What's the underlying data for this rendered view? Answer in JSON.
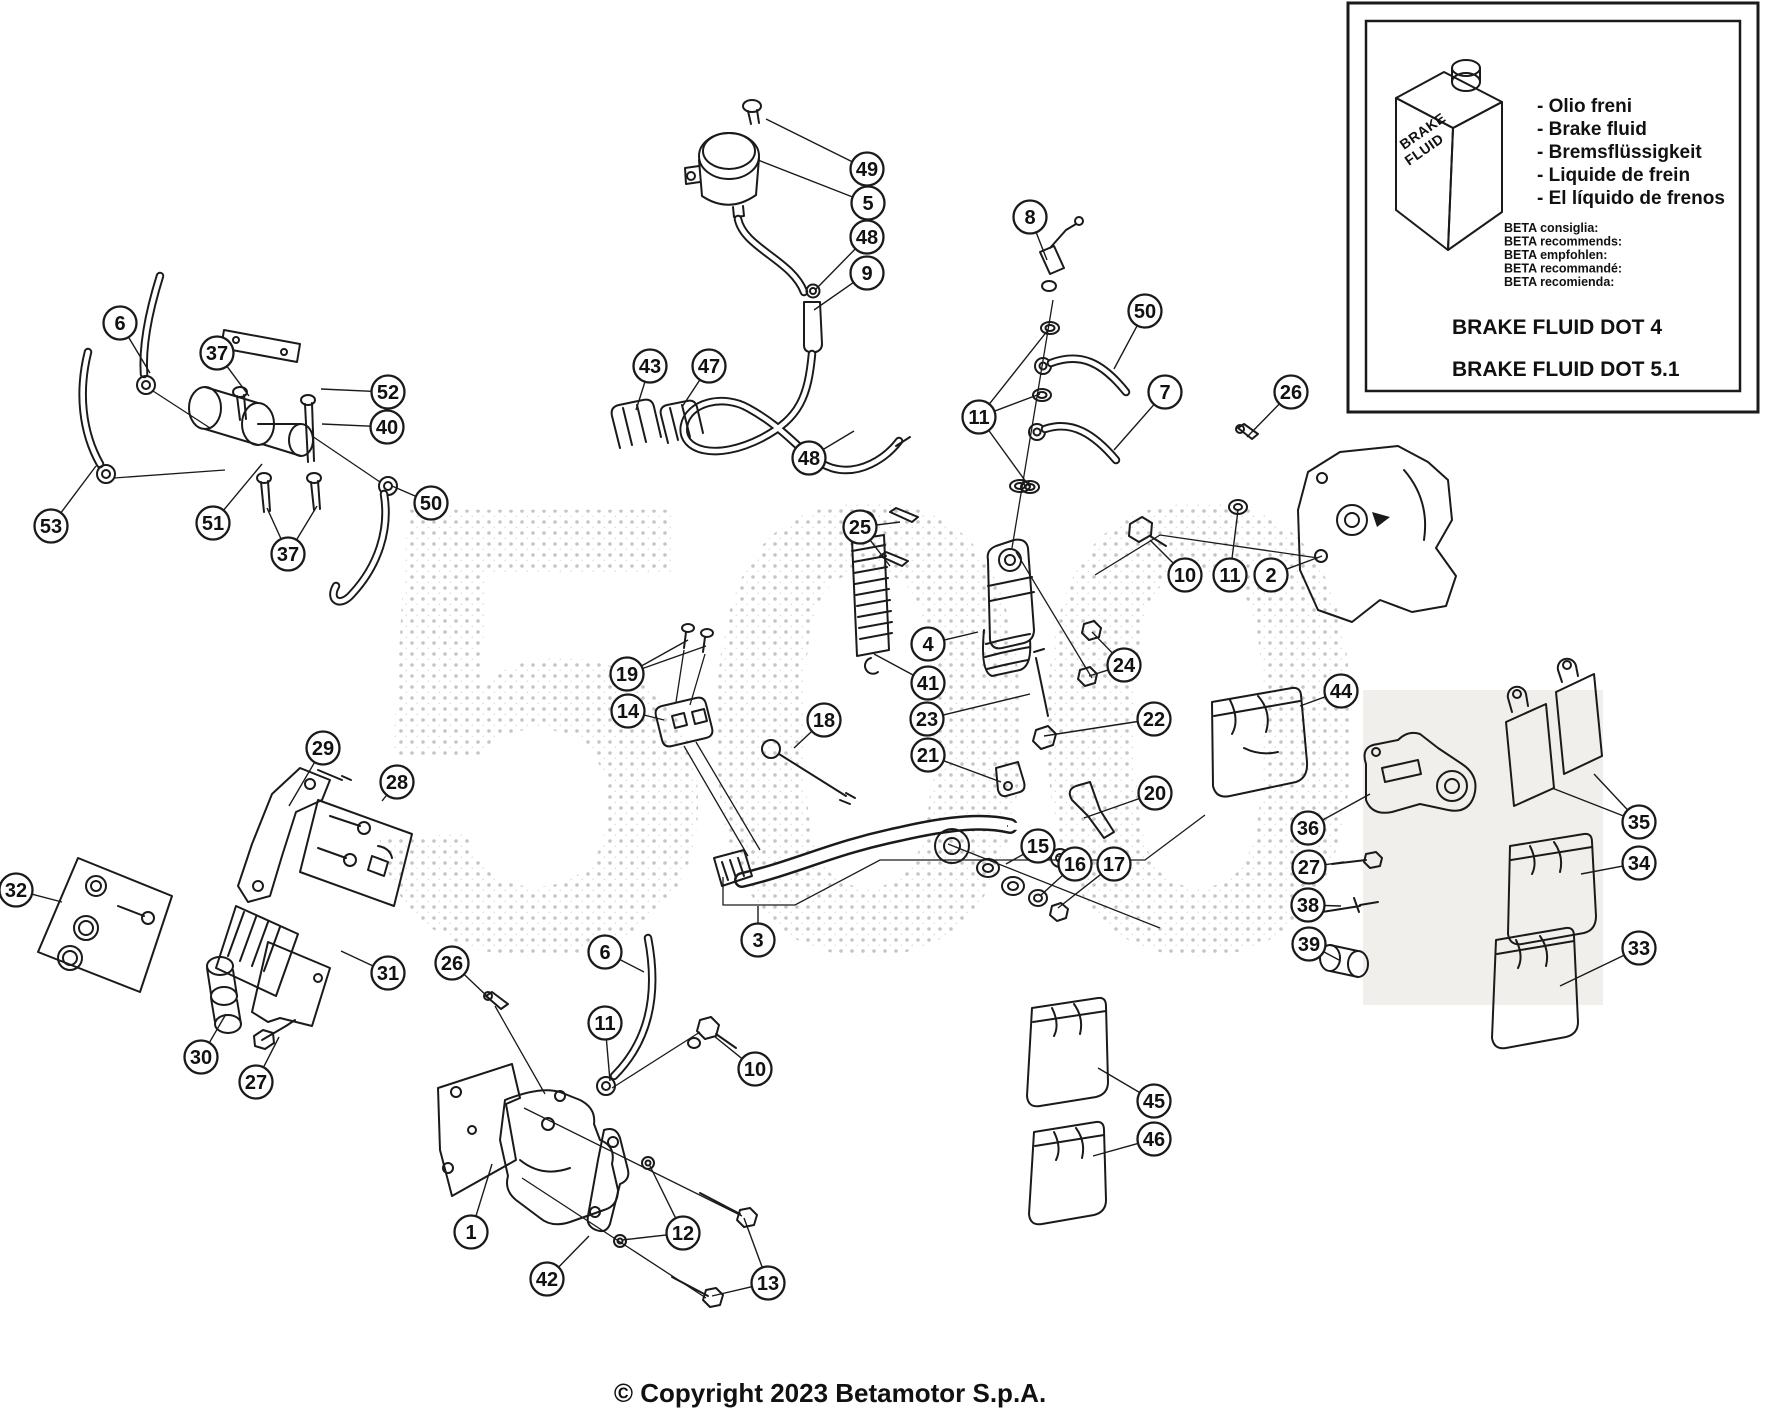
{
  "figure": {
    "width": 1775,
    "height": 1410
  },
  "watermark_text": "500",
  "copyright": "© Copyright 2023 Betamotor S.p.A.",
  "inset": {
    "canister_label_line1": "BRAKE",
    "canister_label_line2": "FLUID",
    "fluid_names": [
      "- Olio freni",
      "- Brake fluid",
      "- Bremsflüssigkeit",
      "- Liquide de frein",
      "- El líquido de frenos"
    ],
    "recommendations": [
      "BETA consiglia:",
      "BETA recommends:",
      "BETA empfohlen:",
      "BETA recommandé:",
      "BETA recomienda:"
    ],
    "spec_dot4": "BRAKE FLUID DOT 4",
    "spec_dot51": "BRAKE FLUID DOT 5.1"
  },
  "callouts": [
    {
      "n": "49",
      "x": 867,
      "y": 169,
      "leads": [
        [
          766,
          119
        ]
      ]
    },
    {
      "n": "5",
      "x": 868,
      "y": 203,
      "leads": [
        [
          758,
          160
        ]
      ]
    },
    {
      "n": "48",
      "x": 867,
      "y": 237,
      "leads": [
        [
          816,
          289
        ]
      ]
    },
    {
      "n": "9",
      "x": 867,
      "y": 273,
      "leads": [
        [
          814,
          310
        ]
      ]
    },
    {
      "n": "8",
      "x": 1030,
      "y": 217,
      "leads": [
        [
          1047,
          260
        ]
      ]
    },
    {
      "n": "50",
      "x": 1145,
      "y": 311,
      "leads": [
        [
          1114,
          369
        ]
      ]
    },
    {
      "n": "7",
      "x": 1165,
      "y": 392,
      "leads": [
        [
          1114,
          450
        ]
      ]
    },
    {
      "n": "26",
      "x": 1291,
      "y": 392,
      "leads": [
        [
          1247,
          437
        ]
      ]
    },
    {
      "n": "43",
      "x": 650,
      "y": 366,
      "leads": [
        [
          636,
          410
        ]
      ]
    },
    {
      "n": "47",
      "x": 709,
      "y": 366,
      "leads": [
        [
          682,
          407
        ]
      ]
    },
    {
      "n": "11",
      "x": 979,
      "y": 417,
      "leads": [
        [
          1048,
          330
        ],
        [
          1040,
          394
        ],
        [
          1029,
          486
        ]
      ]
    },
    {
      "n": "48",
      "x": 809,
      "y": 458,
      "leads": [
        [
          854,
          431
        ]
      ]
    },
    {
      "n": "25",
      "x": 860,
      "y": 527,
      "leads": [
        [
          900,
          522
        ],
        [
          890,
          566
        ]
      ]
    },
    {
      "n": "6",
      "x": 120,
      "y": 323,
      "leads": [
        [
          150,
          373
        ]
      ]
    },
    {
      "n": "37",
      "x": 217,
      "y": 353,
      "leads": [
        [
          249,
          396
        ]
      ]
    },
    {
      "n": "52",
      "x": 388,
      "y": 392,
      "leads": [
        [
          321,
          389
        ]
      ]
    },
    {
      "n": "40",
      "x": 387,
      "y": 427,
      "leads": [
        [
          322,
          424
        ]
      ]
    },
    {
      "n": "53",
      "x": 51,
      "y": 526,
      "leads": [
        [
          96,
          466
        ]
      ]
    },
    {
      "n": "51",
      "x": 213,
      "y": 523,
      "leads": [
        [
          262,
          464
        ]
      ]
    },
    {
      "n": "37",
      "x": 288,
      "y": 554,
      "leads": [
        [
          267,
          508
        ],
        [
          317,
          506
        ]
      ]
    },
    {
      "n": "50",
      "x": 431,
      "y": 503,
      "leads": [
        [
          392,
          486
        ]
      ]
    },
    {
      "n": "10",
      "x": 1185,
      "y": 575,
      "leads": [
        [
          1150,
          540
        ]
      ]
    },
    {
      "n": "11",
      "x": 1230,
      "y": 575,
      "leads": [
        [
          1238,
          510
        ]
      ]
    },
    {
      "n": "2",
      "x": 1271,
      "y": 575,
      "leads": [
        [
          1322,
          556
        ]
      ]
    },
    {
      "n": "4",
      "x": 928,
      "y": 644,
      "leads": [
        [
          978,
          632
        ]
      ]
    },
    {
      "n": "41",
      "x": 928,
      "y": 683,
      "leads": [
        [
          874,
          654
        ]
      ]
    },
    {
      "n": "23",
      "x": 927,
      "y": 719,
      "leads": [
        [
          1030,
          694
        ]
      ]
    },
    {
      "n": "21",
      "x": 928,
      "y": 755,
      "leads": [
        [
          1001,
          782
        ]
      ]
    },
    {
      "n": "24",
      "x": 1124,
      "y": 665,
      "leads": [
        [
          1092,
          632
        ],
        [
          1089,
          676
        ]
      ]
    },
    {
      "n": "22",
      "x": 1154,
      "y": 719,
      "leads": [
        [
          1044,
          736
        ]
      ]
    },
    {
      "n": "20",
      "x": 1155,
      "y": 793,
      "leads": [
        [
          1084,
          818
        ]
      ]
    },
    {
      "n": "19",
      "x": 627,
      "y": 674,
      "leads": [
        [
          688,
          640
        ],
        [
          706,
          646
        ]
      ]
    },
    {
      "n": "14",
      "x": 628,
      "y": 711,
      "leads": [
        [
          664,
          720
        ]
      ]
    },
    {
      "n": "18",
      "x": 824,
      "y": 720,
      "leads": [
        [
          794,
          748
        ]
      ]
    },
    {
      "n": "15",
      "x": 1038,
      "y": 846,
      "leads": [
        [
          1006,
          864
        ]
      ]
    },
    {
      "n": "16",
      "x": 1075,
      "y": 864,
      "leads": [
        [
          1040,
          896
        ]
      ]
    },
    {
      "n": "17",
      "x": 1114,
      "y": 864,
      "leads": [
        [
          1058,
          908
        ]
      ]
    },
    {
      "n": "3",
      "x": 758,
      "y": 940,
      "leads": [
        [
          758,
          906
        ]
      ]
    },
    {
      "n": "44",
      "x": 1341,
      "y": 691,
      "leads": [
        [
          1300,
          706
        ]
      ]
    },
    {
      "n": "36",
      "x": 1308,
      "y": 828,
      "leads": [
        [
          1370,
          794
        ]
      ]
    },
    {
      "n": "27",
      "x": 1309,
      "y": 867,
      "leads": [
        [
          1344,
          862
        ]
      ]
    },
    {
      "n": "38",
      "x": 1308,
      "y": 905,
      "leads": [
        [
          1341,
          906
        ]
      ]
    },
    {
      "n": "39",
      "x": 1309,
      "y": 944,
      "leads": [
        [
          1339,
          960
        ]
      ]
    },
    {
      "n": "35",
      "x": 1639,
      "y": 822,
      "leads": [
        [
          1552,
          788
        ],
        [
          1594,
          774
        ]
      ]
    },
    {
      "n": "34",
      "x": 1639,
      "y": 863,
      "leads": [
        [
          1581,
          874
        ]
      ]
    },
    {
      "n": "33",
      "x": 1639,
      "y": 948,
      "leads": [
        [
          1560,
          986
        ]
      ]
    },
    {
      "n": "45",
      "x": 1154,
      "y": 1101,
      "leads": [
        [
          1098,
          1068
        ]
      ]
    },
    {
      "n": "46",
      "x": 1154,
      "y": 1139,
      "leads": [
        [
          1093,
          1156
        ]
      ]
    },
    {
      "n": "29",
      "x": 323,
      "y": 748,
      "leads": [
        [
          289,
          806
        ]
      ]
    },
    {
      "n": "28",
      "x": 397,
      "y": 782,
      "leads": [
        [
          382,
          801
        ]
      ]
    },
    {
      "n": "32",
      "x": 16,
      "y": 890,
      "leads": [
        [
          62,
          902
        ]
      ]
    },
    {
      "n": "31",
      "x": 388,
      "y": 973,
      "leads": [
        [
          341,
          951
        ]
      ]
    },
    {
      "n": "30",
      "x": 201,
      "y": 1057,
      "leads": [
        [
          226,
          1014
        ]
      ]
    },
    {
      "n": "27",
      "x": 256,
      "y": 1082,
      "leads": [
        [
          279,
          1037
        ]
      ]
    },
    {
      "n": "26",
      "x": 452,
      "y": 963,
      "leads": [
        [
          490,
          999
        ]
      ]
    },
    {
      "n": "6",
      "x": 605,
      "y": 952,
      "leads": [
        [
          644,
          972
        ]
      ]
    },
    {
      "n": "11",
      "x": 605,
      "y": 1023,
      "leads": [
        [
          610,
          1081
        ]
      ]
    },
    {
      "n": "10",
      "x": 755,
      "y": 1069,
      "leads": [
        [
          714,
          1036
        ]
      ]
    },
    {
      "n": "1",
      "x": 471,
      "y": 1232,
      "leads": [
        [
          492,
          1164
        ]
      ]
    },
    {
      "n": "42",
      "x": 547,
      "y": 1279,
      "leads": [
        [
          589,
          1236
        ]
      ]
    },
    {
      "n": "12",
      "x": 683,
      "y": 1233,
      "leads": [
        [
          650,
          1166
        ],
        [
          622,
          1240
        ]
      ]
    },
    {
      "n": "13",
      "x": 768,
      "y": 1283,
      "leads": [
        [
          744,
          1218
        ],
        [
          712,
          1296
        ]
      ]
    }
  ]
}
